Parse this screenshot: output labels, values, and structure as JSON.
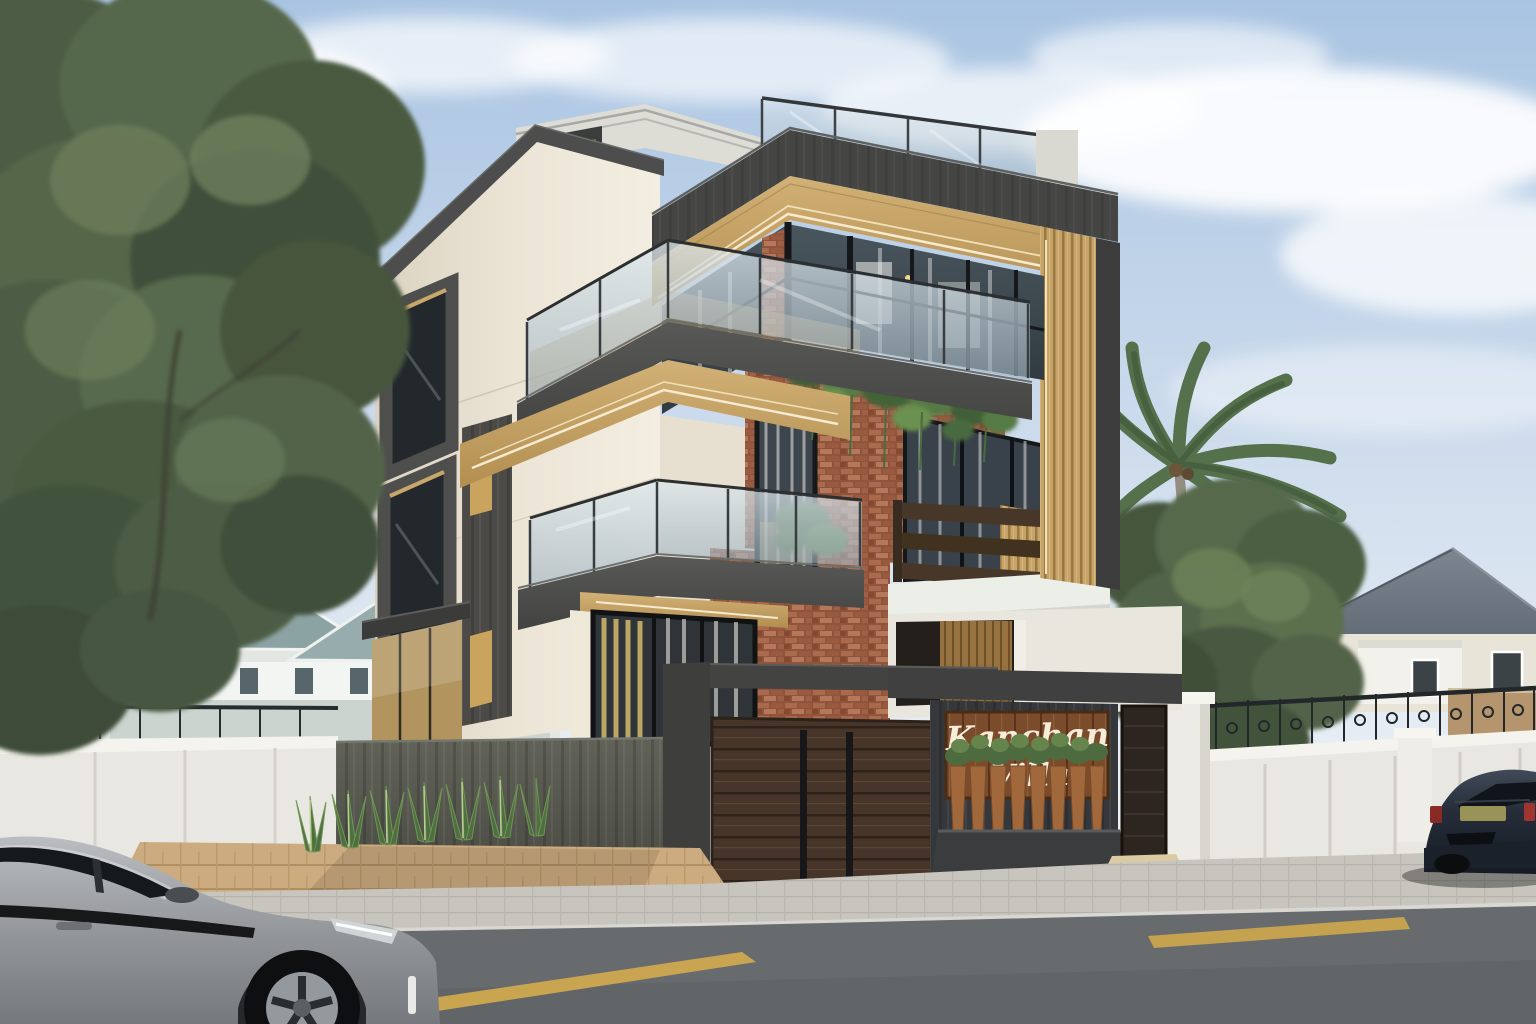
{
  "scene": {
    "type": "architectural-3d-render",
    "subject": "modern three-storey corner villa exterior",
    "time_of_day": "daytime, soft blue sky with clouds"
  },
  "sign": {
    "line1": "Kanchan",
    "line2": "Villa",
    "text_color": "#f5ecd9",
    "board_color": "#7b4c2b"
  },
  "villa": {
    "floors": 3,
    "features": [
      "rooftop glass railing terrace",
      "dark charcoal fascia band with golden wood-slat soffit and LED strip lighting",
      "corner glass window wall with black mullions",
      "glass balcony railings on two floors",
      "horizontal dark wood slat balcony railing",
      "vertical golden wood slat corner column",
      "exposed terracotta brick feature column",
      "cream textured stucco facade with dark stone window surrounds",
      "hanging trailing plants from balcony",
      "dark stone compound wall with horizontal wood slat gate",
      "wooden name board with planter box of potted plants"
    ]
  },
  "environment": {
    "left": [
      "large deciduous tree",
      "white compound wall with iron fence",
      "neighbour house with teal-grey gable roofs"
    ],
    "right": [
      "palm tree",
      "green tree",
      "neighbour house with grey gable roof and cream walls",
      "white boundary wall with black wrought-iron scroll fence",
      "tan building"
    ],
    "foreground": [
      "tan paver driveway",
      "agave shrubs row",
      "grey paver sidewalk",
      "asphalt road with yellow dashed centre line",
      "grey hatchback car (front half, side view)",
      "dark navy sedan parked (rear view)"
    ]
  },
  "palette": {
    "sky_top": "#a9c4e2",
    "sky_horizon": "#eef3f7",
    "stucco_cream": "#ece5d6",
    "dark_stone": "#454644",
    "charcoal_wall": "#575854",
    "wood_slat_gold": "#c6a368",
    "led_strip": "#f6ead0",
    "brick": "#a06048",
    "railing_glass": "#c3d2db",
    "window_glass": "#3e4a51",
    "gate_wood": "#473529",
    "planter_pot": "#a1683c",
    "foliage": "#4d5d44",
    "palm_green": "#55714c",
    "driveway_paver": "#cbab7f",
    "sidewalk": "#c7c5bd",
    "road": "#686b6e",
    "road_marking": "#d2aa4e",
    "car_grey": "#8f9296",
    "car_navy": "#232a36",
    "neighbour_roof": "#6e7681",
    "boundary_wall": "#e9e7e1",
    "iron_fence": "#23272a"
  }
}
